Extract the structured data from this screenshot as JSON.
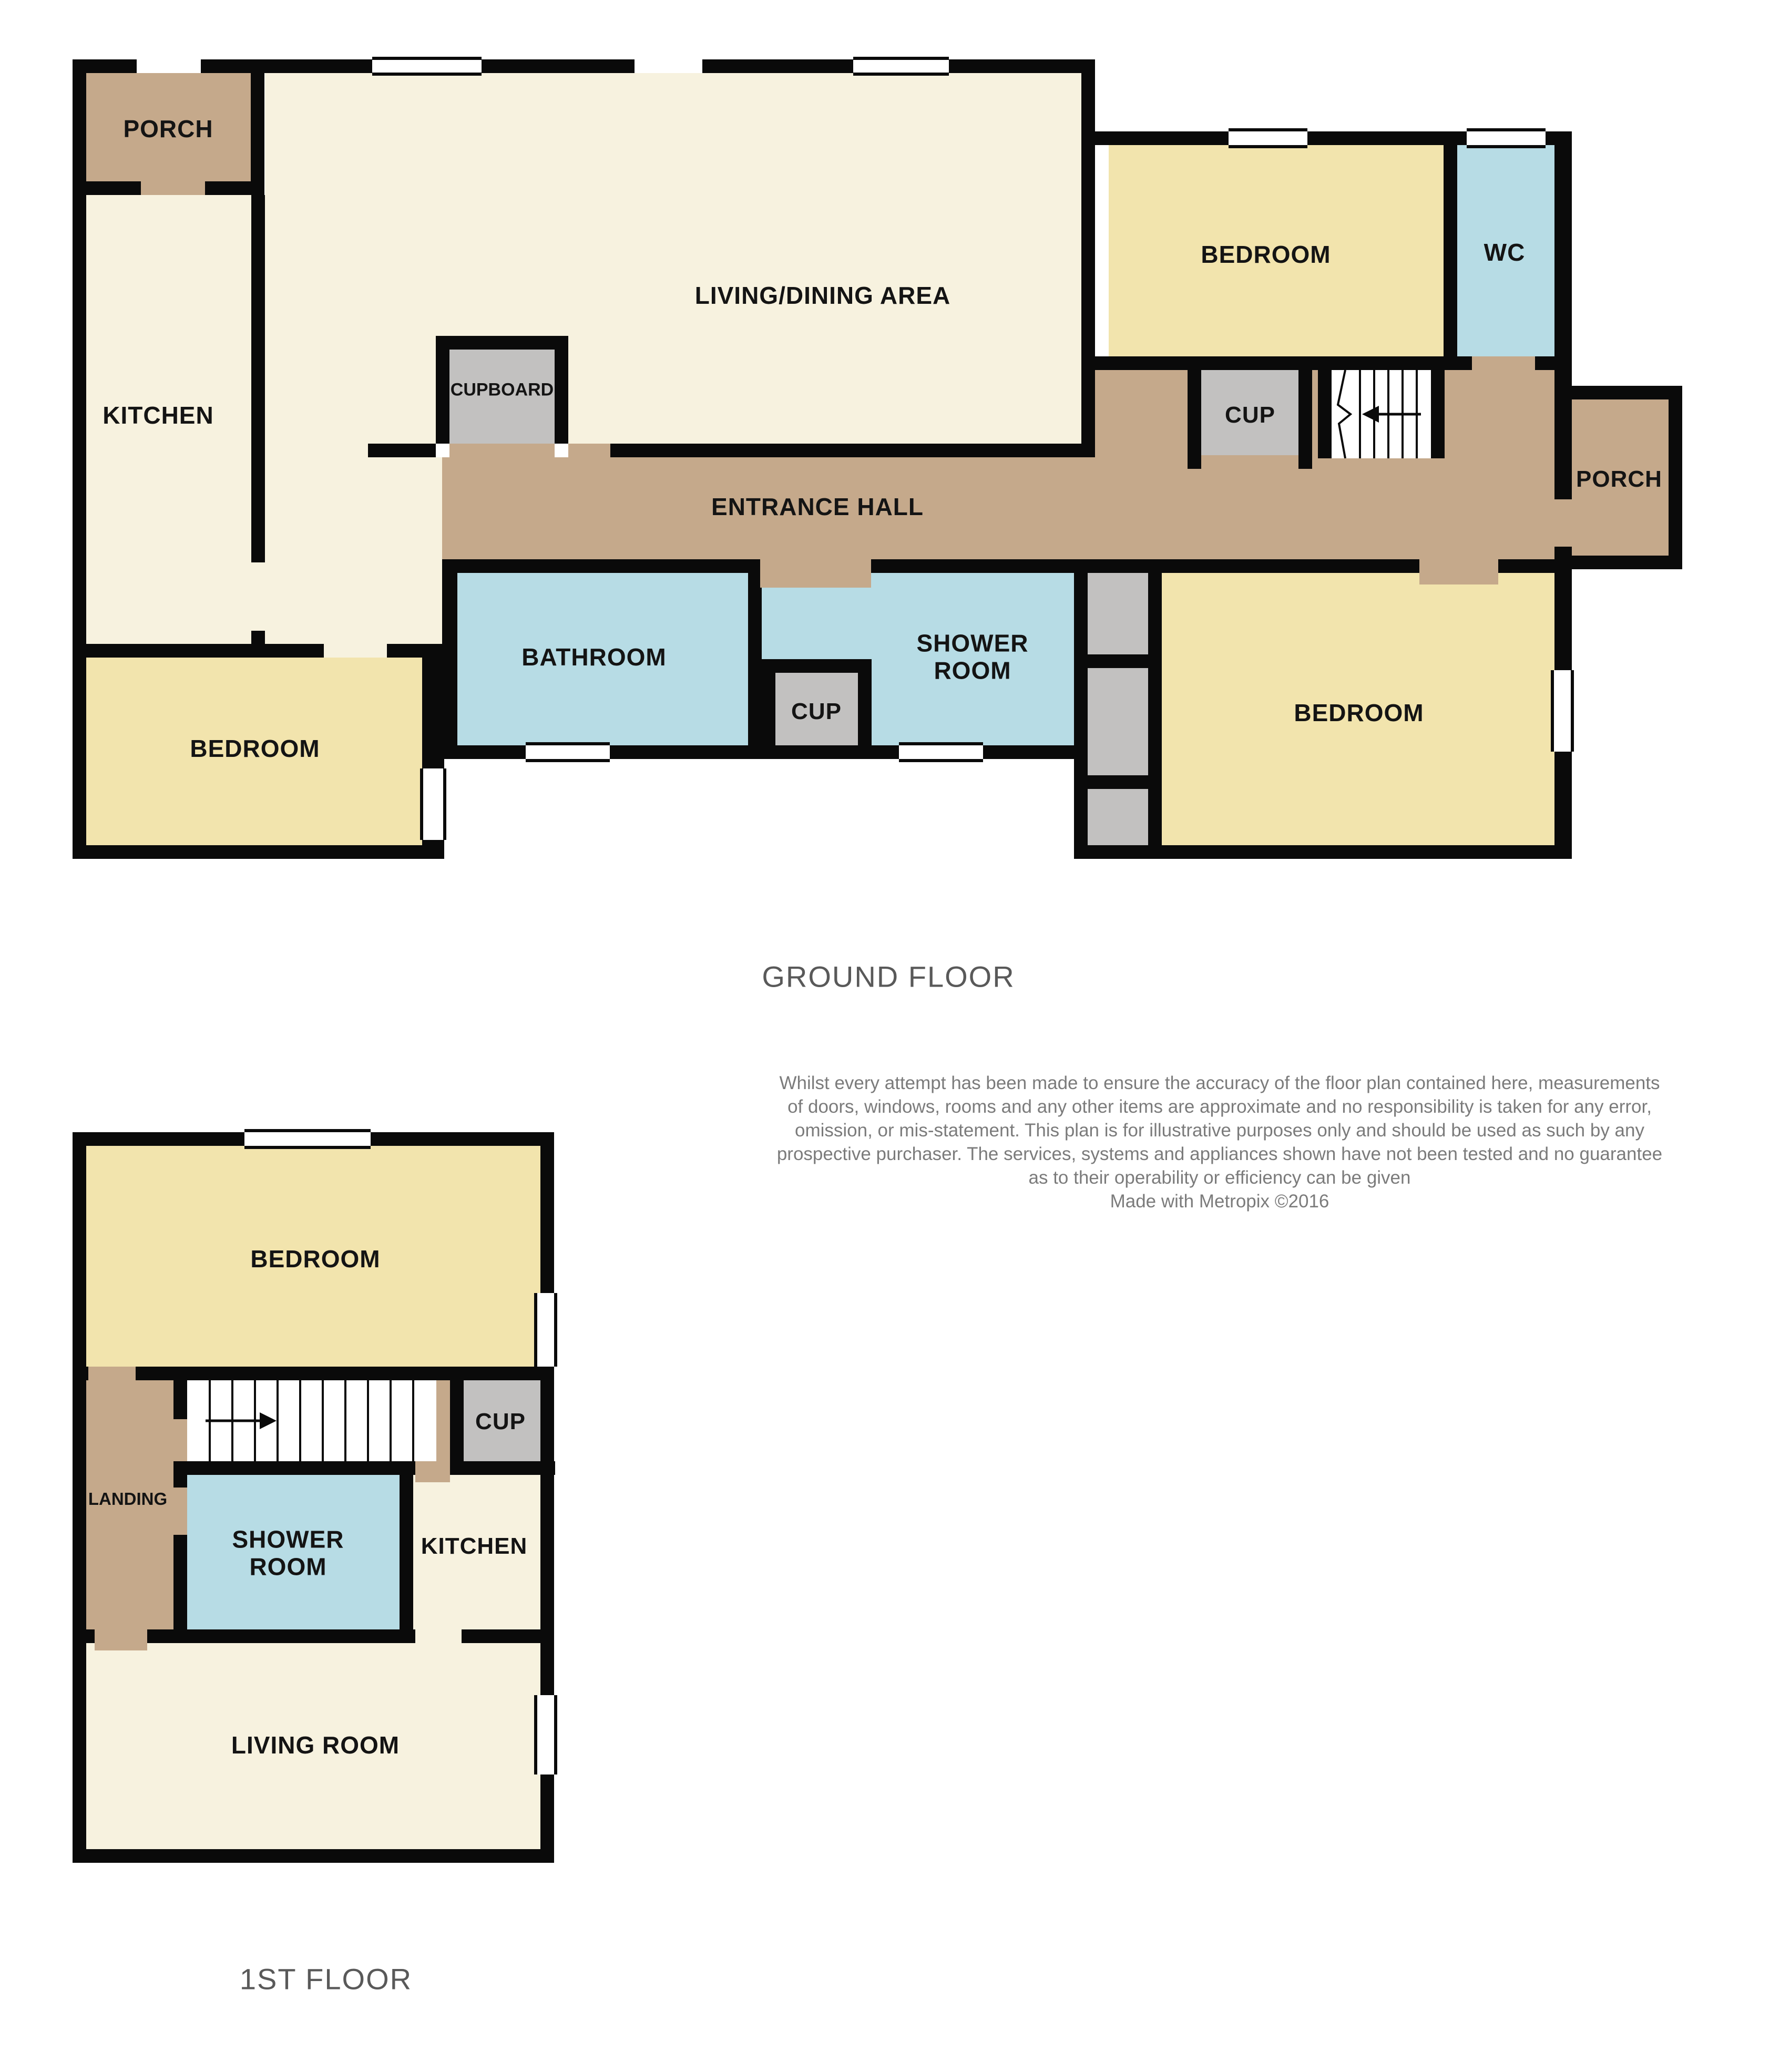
{
  "titles": {
    "ground_floor": "GROUND FLOOR",
    "first_floor": "1ST FLOOR"
  },
  "disclaimer": {
    "line1": "Whilst every attempt has been made to ensure the accuracy of the floor plan contained here, measurements",
    "line2": "of doors, windows, rooms and any other items are approximate and no responsibility is taken for any error,",
    "line3": "omission, or mis-statement. This plan is for illustrative purposes only and should be used as such by any",
    "line4": "prospective purchaser. The services, systems and appliances shown have not been tested and no guarantee",
    "line5": "as to their operability or efficiency can be given",
    "line6": "Made with Metropix ©2016"
  },
  "ground_floor": {
    "rooms": {
      "porch_top": "PORCH",
      "kitchen": "KITCHEN",
      "living_dining": "LIVING/DINING AREA",
      "cupboard": "CUPBOARD",
      "bedroom_top_right": "BEDROOM",
      "wc": "WC",
      "cup_by_stairs": "CUP",
      "porch_right": "PORCH",
      "entrance_hall": "ENTRANCE HALL",
      "bathroom": "BATHROOM",
      "cup_small": "CUP",
      "shower_room": "SHOWER ROOM",
      "bedroom_bottom_left": "BEDROOM",
      "bedroom_bottom_right": "BEDROOM"
    }
  },
  "first_floor": {
    "rooms": {
      "bedroom": "BEDROOM",
      "landing": "LANDING",
      "cup": "CUP",
      "shower_room": "SHOWER ROOM",
      "kitchen": "KITCHEN",
      "living_room": "LIVING ROOM"
    }
  },
  "colors": {
    "wall": "#0a0a0a",
    "room_cream": "#f7f2df",
    "room_yellow": "#f2e4ad",
    "room_tan": "#c5a98b",
    "room_blue": "#b7dce5",
    "room_gray": "#c2c1c0",
    "title_text": "#595959",
    "disclaimer_text": "#7b7b7b",
    "label_text": "#141414"
  },
  "icons": {
    "stairs_arrow_ground": "stairs-direction-arrow-left",
    "stairs_arrow_first": "stairs-direction-arrow-right"
  }
}
